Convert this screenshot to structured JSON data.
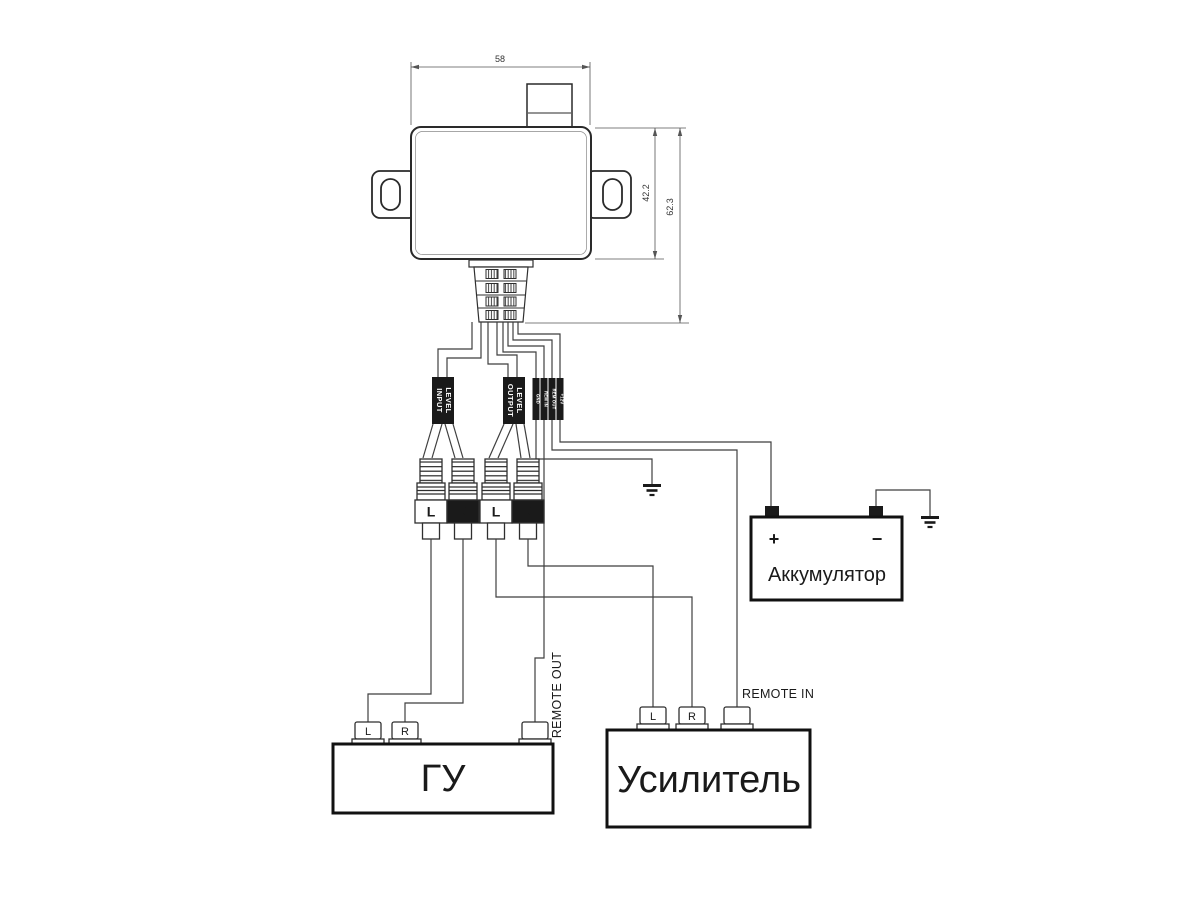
{
  "diagram": {
    "device": {
      "width_label": "58",
      "body_height_label": "42.2",
      "total_height_label": "62.3"
    },
    "cable_labels": {
      "input_line1": "LEVEL",
      "input_line2": "INPUT",
      "output_line1": "LEVEL",
      "output_line2": "OUTPUT",
      "wires": [
        "GND",
        "REM IN",
        "REM OUT",
        "+12V"
      ]
    },
    "rca_plugs": [
      {
        "label": "L",
        "style": "light"
      },
      {
        "label": "R",
        "style": "dark"
      },
      {
        "label": "L",
        "style": "light"
      },
      {
        "label": "R",
        "style": "dark"
      }
    ],
    "head_unit": {
      "title": "ГУ",
      "left": "L",
      "right": "R",
      "remote": "REMOTE OUT"
    },
    "amplifier": {
      "title": "Усилитель",
      "left": "L",
      "right": "R",
      "remote": "REMOTE IN"
    },
    "battery": {
      "title": "Аккумулятор",
      "positive": "+",
      "negative": "−"
    },
    "colors": {
      "background": "#ffffff",
      "line": "#3f3f3f",
      "outline": "#2a2a2a",
      "heavy": "#111111",
      "fill_dark": "#1a1a1a"
    }
  }
}
